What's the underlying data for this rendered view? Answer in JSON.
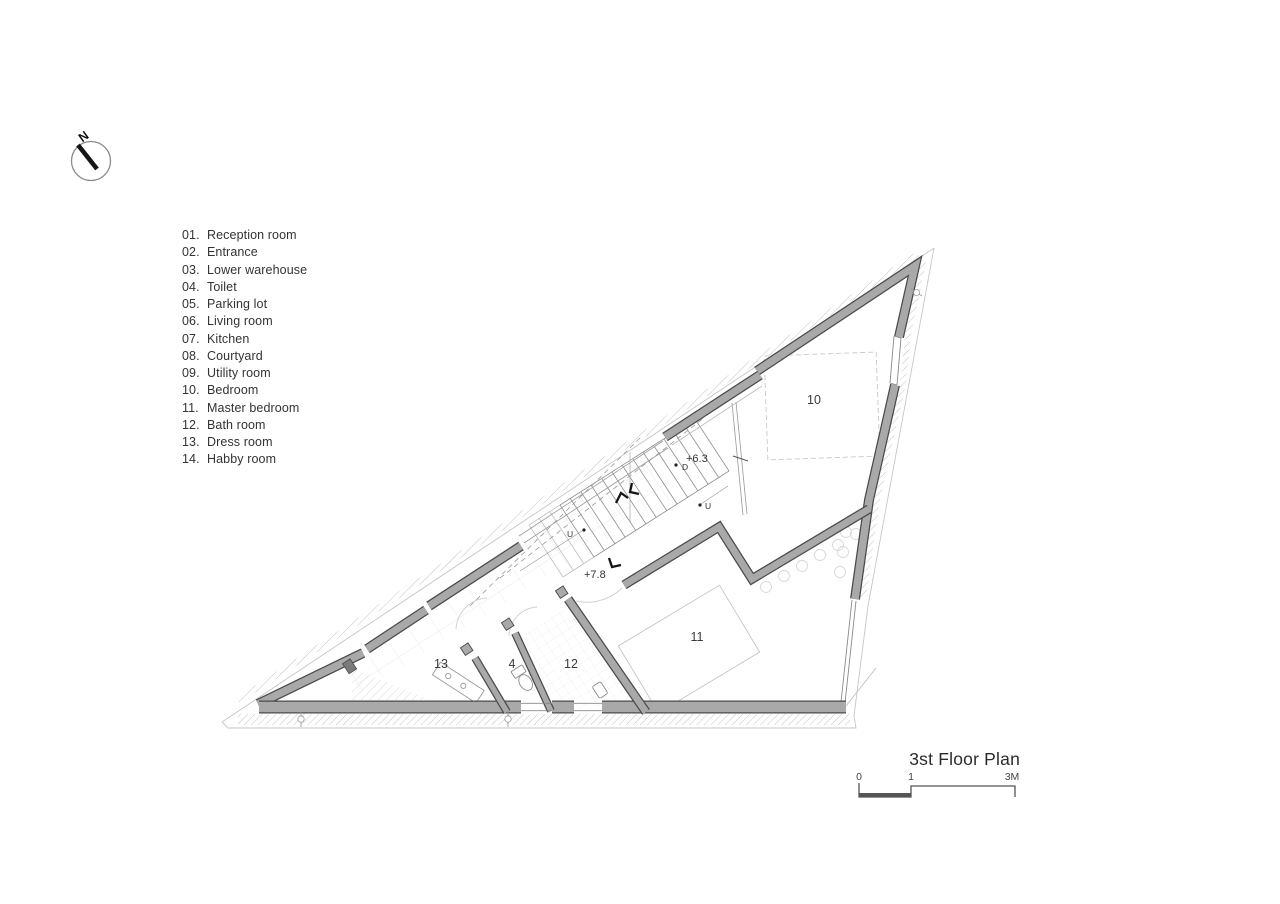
{
  "colors": {
    "wall_fill": "#a9a9a9",
    "wall_outline": "#4a4a4a",
    "hatch_line": "#b4b4b4",
    "light_line": "#c8c8c8",
    "text_dark": "#333333"
  },
  "north": {
    "letter": "N"
  },
  "legend": {
    "items": [
      {
        "num": "01.",
        "label": "Reception room"
      },
      {
        "num": "02.",
        "label": "Entrance"
      },
      {
        "num": "03.",
        "label": "Lower warehouse"
      },
      {
        "num": "04.",
        "label": "Toilet"
      },
      {
        "num": "05.",
        "label": "Parking lot"
      },
      {
        "num": "06.",
        "label": "Living room"
      },
      {
        "num": "07.",
        "label": "Kitchen"
      },
      {
        "num": "08.",
        "label": "Courtyard"
      },
      {
        "num": "09.",
        "label": "Utility room"
      },
      {
        "num": "10.",
        "label": "Bedroom"
      },
      {
        "num": "11.",
        "label": "Master bedroom"
      },
      {
        "num": "12.",
        "label": "Bath room"
      },
      {
        "num": "13.",
        "label": "Dress room"
      },
      {
        "num": "14.",
        "label": "Habby room"
      }
    ]
  },
  "plan": {
    "room_labels": [
      {
        "text": "10"
      },
      {
        "text": "11"
      },
      {
        "text": "12"
      },
      {
        "text": "4"
      },
      {
        "text": "13"
      }
    ],
    "level_markers": [
      {
        "text": "+6.3"
      },
      {
        "text": "+7.8"
      }
    ],
    "stair_markers": [
      {
        "text": "D"
      },
      {
        "text": "U"
      },
      {
        "text": "U"
      }
    ]
  },
  "titleblock": {
    "title": "3st Floor Plan",
    "scale_labels": [
      "0",
      "1",
      "3M"
    ]
  }
}
